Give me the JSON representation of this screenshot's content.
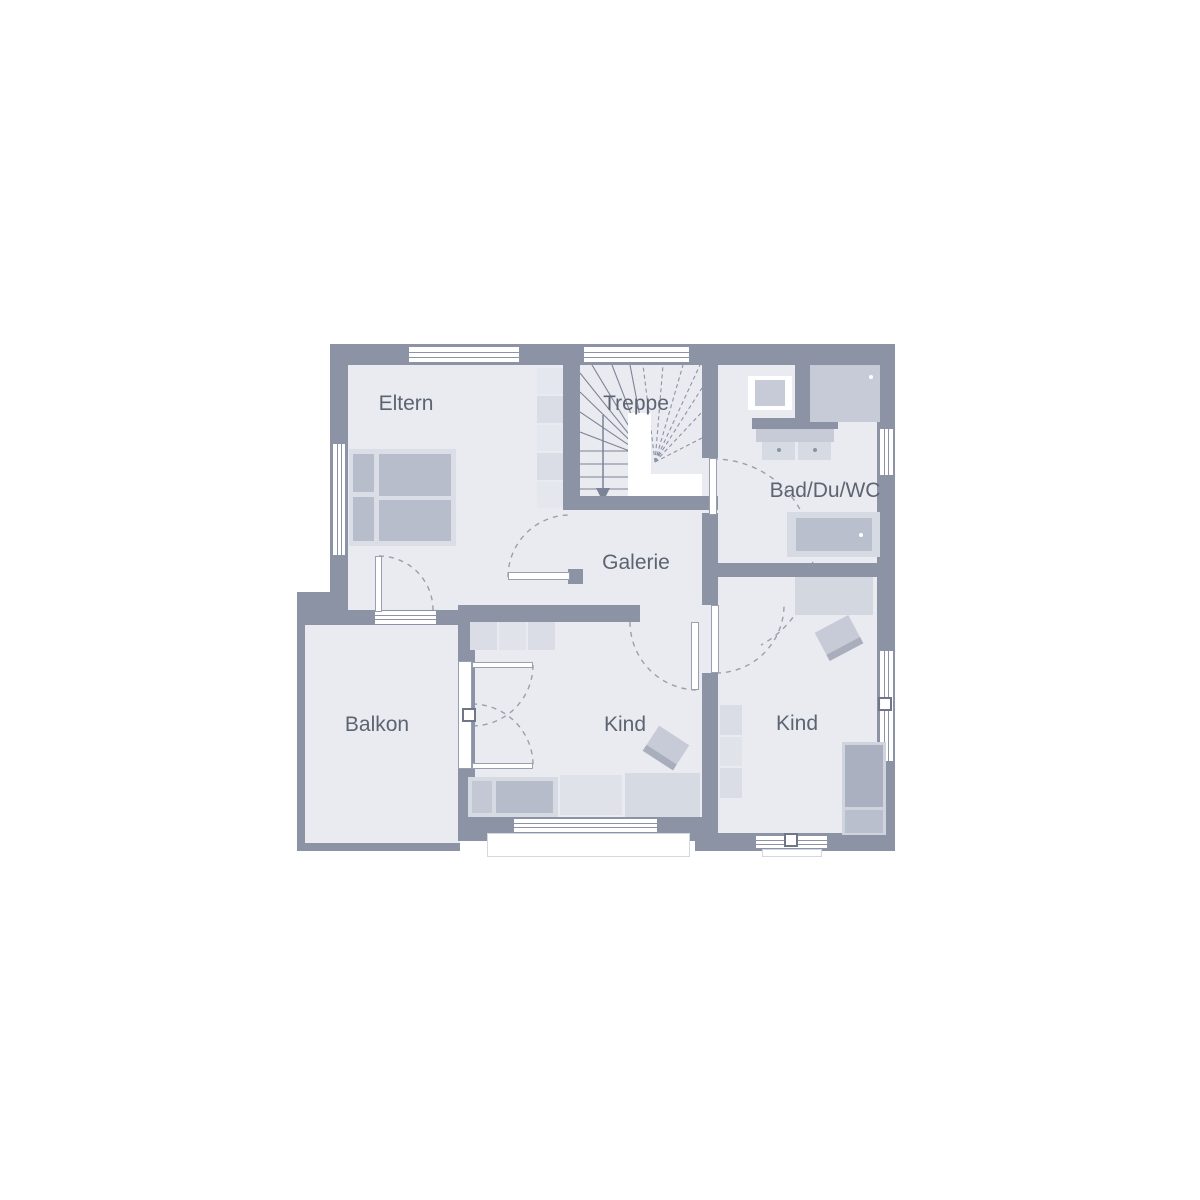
{
  "rooms": [
    {
      "id": "eltern",
      "label": "Eltern"
    },
    {
      "id": "treppe",
      "label": "Treppe"
    },
    {
      "id": "bad",
      "label": "Bad/Du/WC"
    },
    {
      "id": "galerie",
      "label": "Galerie"
    },
    {
      "id": "balkon",
      "label": "Balkon"
    },
    {
      "id": "kind-left",
      "label": "Kind"
    },
    {
      "id": "kind-right",
      "label": "Kind"
    }
  ],
  "colors": {
    "wall": "#8b93a5",
    "room_fill": "#e9ebf0",
    "furniture_light": "#dcdfe7",
    "furniture_mid": "#c6cbd7",
    "furniture_dark": "#abb1c0",
    "text": "#5c6472",
    "swing_line": "#98a0af",
    "background": "#ffffff"
  }
}
